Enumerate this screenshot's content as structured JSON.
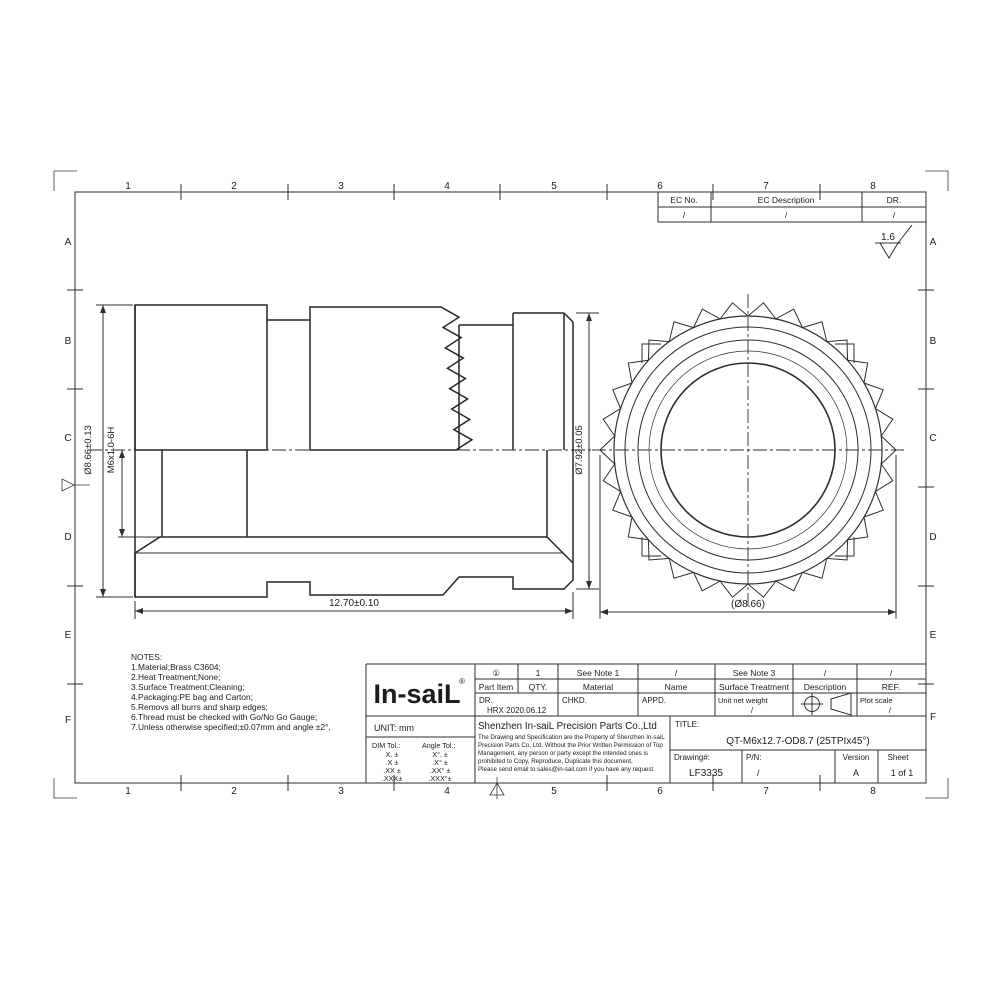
{
  "sheet": {
    "frame": {
      "cols": [
        "1",
        "2",
        "3",
        "4",
        "5",
        "6",
        "7",
        "8"
      ],
      "rows": [
        "A",
        "B",
        "C",
        "D",
        "E",
        "F"
      ]
    },
    "ec_table": {
      "col1": "EC No.",
      "col2": "EC Description",
      "col3": "DR.",
      "val1": "/",
      "val2": "/",
      "val3": "/"
    },
    "roughness_value": "1.6"
  },
  "drawing": {
    "dim_od": "Ø8.66±0.13",
    "dim_thread": "M6x1.0-6H",
    "dim_flange": "Ø7.92±0.05",
    "dim_length": "12.70±0.10",
    "dim_od_ref": "(Ø8.66)"
  },
  "notes": {
    "title": "NOTES:",
    "lines": [
      "1.Material;Brass C3604;",
      "2.Heat Treatment;None;",
      "3.Surface Treatment;Cleaning;",
      "4.Packaging:PE bag and Carton;",
      "5.Removs all burrs and sharp edges;",
      "6.Thread must be checked with Go/No Go Gauge;",
      "7.Unless otherwise specified;±0.07mm and angle ±2°,"
    ]
  },
  "title_block": {
    "logo": "In-saiL",
    "logo_reg": "®",
    "unit": "UNIT: mm",
    "dim_tol_label": "DIM Tol.:",
    "angle_tol_label": "Angle Tol.:",
    "dim_tol": [
      "X. ±",
      ".X ±",
      ".XX ±",
      ".XXX±"
    ],
    "angle_tol": [
      "X°. ±",
      ".X° ±",
      ".XX° ±",
      ".XXX°±"
    ],
    "values": [
      "①",
      "1",
      "See Note 1",
      "/",
      "See Note 3",
      "/",
      "/"
    ],
    "labels": [
      "Part Item",
      "QTY.",
      "Material",
      "Name",
      "Surface Treatment",
      "Description",
      "REF."
    ],
    "dr_label": "DR.",
    "dr_value": "HRX 2020.06.12",
    "chkd_label": "CHKD.",
    "appd_label": "APPD.",
    "weight_label": "Unit net weight",
    "weight_value": "/",
    "plot_scale_label": "Plot scale",
    "plot_scale_value": "/",
    "company": "Shenzhen In-saiL Precision Parts Co.,Ltd",
    "disclaimer": [
      "The Drawing and Specification are the Property of Shenzhen In-saiL",
      "Precision Parts Co, Ltd, Without the Prior Written Permission of Top",
      "Management, any person or party except the intended ones is",
      "prohibited to Copy, Reproduce, Duplicate this document,",
      "Please send email to sales@in-sail.com if you have any request."
    ],
    "title_label": "TITLE:",
    "title_value": "QT-M6x12.7-OD8.7 (25TPIx45°)",
    "drawing_label": "Drawing#:",
    "drawing_value": "LF3335",
    "pn_label": "P/N:",
    "pn_value": "/",
    "version_label": "Version",
    "version_value": "A",
    "sheet_label": "Sheet",
    "sheet_value": "1 of 1"
  }
}
